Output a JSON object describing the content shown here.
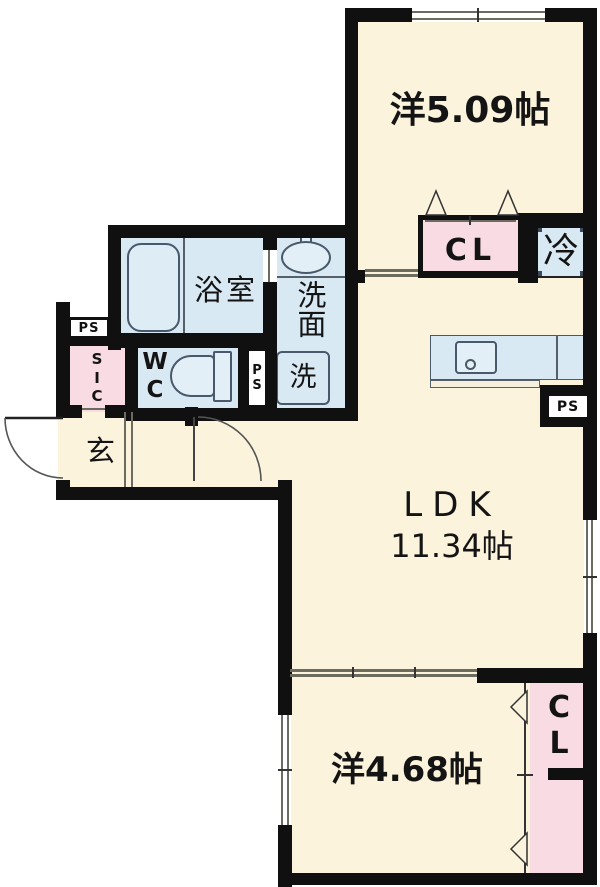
{
  "labels": {
    "room_top": "洋5.09帖",
    "closet_top": "CL",
    "fridge": "冷",
    "bath": "浴室",
    "washroom": "洗面",
    "washer": "洗",
    "wc": {
      "w": "W",
      "c": "C"
    },
    "ps_entry": "PS",
    "sic": {
      "s": "S",
      "i": "I",
      "c": "C"
    },
    "ps_mid": {
      "p": "P",
      "s": "S"
    },
    "entrance": "玄",
    "ldk": "LDK",
    "ldk_size": "11.34帖",
    "ps_kitchen": "PS",
    "room_bottom": "洋4.68帖",
    "closet_bottom": {
      "c": "C",
      "l": "L"
    }
  },
  "colors": {
    "floor": "#fbf3dc",
    "wet_area": "#d8e9f3",
    "closet": "#f8dbe3",
    "wall": "#101010",
    "exterior": "#ffffff"
  }
}
